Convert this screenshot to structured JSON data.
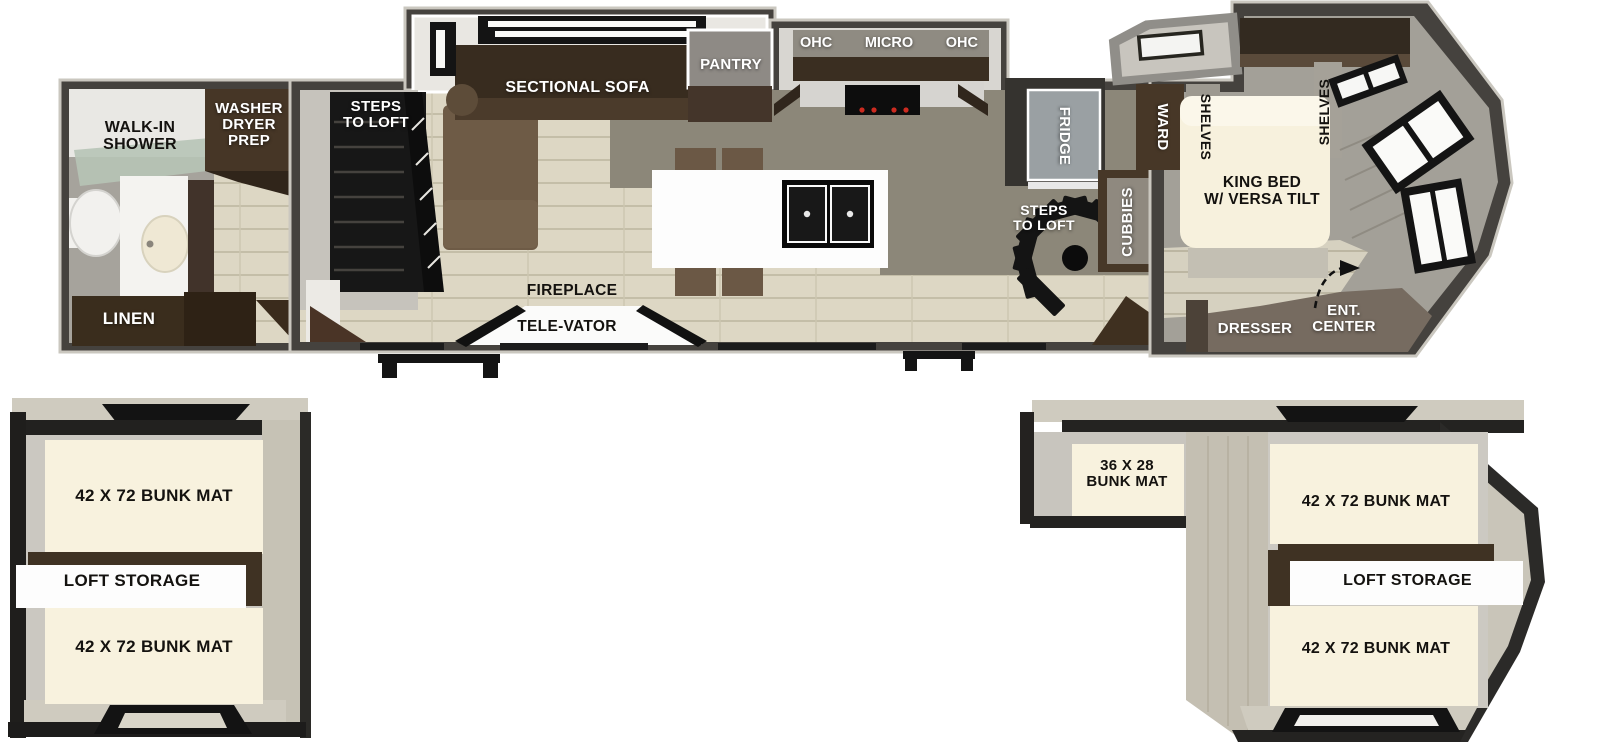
{
  "diagram_type": "rv-floorplan-with-lofts",
  "colors": {
    "wall_dark": "#45423e",
    "wall_outline_light": "#cac7bf",
    "floor_plank_light": "#ddd7c4",
    "floor_gray": "#a5a19a",
    "kitchen_floor_dark": "#8c8779",
    "sofa_back_brown": "#382c1f",
    "sofa_seat_brown": "#6e5b46",
    "cabinet_dark_brown": "#44352a",
    "bunk_mat_cream": "#f8f2de",
    "loft_wall_beige": "#cbc7ba",
    "dresser_taupe": "#766b60",
    "label_white": "#ffffff",
    "label_black": "#14120f",
    "window_black": "#141414"
  },
  "main_floorplan": {
    "bathroom": {
      "walk_in_shower": "WALK-IN\nSHOWER",
      "washer_dryer_prep": "WASHER\nDRYER\nPREP",
      "linen": "LINEN"
    },
    "living": {
      "steps_to_loft": "STEPS\nTO LOFT",
      "sectional_sofa": "SECTIONAL SOFA",
      "fireplace": "FIREPLACE",
      "tele_vator": "TELE-VATOR"
    },
    "kitchen": {
      "pantry": "PANTRY",
      "ohc_left": "OHC",
      "micro": "MICRO",
      "ohc_right": "OHC",
      "fridge": "FRIDGE",
      "steps_to_loft": "STEPS\nTO LOFT",
      "cubbies": "CUBBIES"
    },
    "bedroom": {
      "ward": "WARD",
      "shelves_left": "SHELVES",
      "shelves_right": "SHELVES",
      "king_bed": "KING BED\nW/ VERSA TILT",
      "dresser": "DRESSER",
      "ent_center": "ENT.\nCENTER"
    }
  },
  "loft_left": {
    "bunk_top": "42 X 72 BUNK MAT",
    "storage": "LOFT STORAGE",
    "bunk_bottom": "42 X 72 BUNK MAT"
  },
  "loft_right": {
    "bunk_small": "36 X 28\nBUNK MAT",
    "bunk_top": "42 X 72 BUNK MAT",
    "storage": "LOFT STORAGE",
    "bunk_bottom": "42 X 72 BUNK MAT"
  }
}
